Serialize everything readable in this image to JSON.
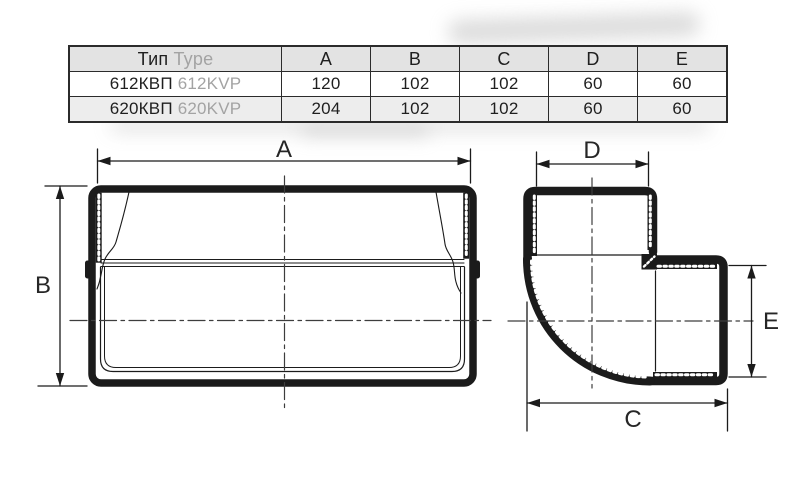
{
  "table": {
    "type_header": {
      "ru": "Тип",
      "en": "Type"
    },
    "dim_headers": [
      "A",
      "B",
      "C",
      "D",
      "E"
    ],
    "rows": [
      {
        "type_ru": "612КВП",
        "type_en": "612KVP",
        "values": [
          "120",
          "102",
          "102",
          "60",
          "60"
        ]
      },
      {
        "type_ru": "620КВП",
        "type_en": "620KVP",
        "values": [
          "204",
          "102",
          "102",
          "60",
          "60"
        ]
      }
    ]
  },
  "drawings": {
    "front_view": {
      "width_label": "A",
      "height_label": "B"
    },
    "elbow_view": {
      "top_label": "D",
      "right_label": "E",
      "bottom_label": "C"
    }
  },
  "colors": {
    "line": "#1b1b1b",
    "centerline": "#3d3d3d",
    "table_border": "#2b2b2b",
    "table_header_bg": "#e3e3e3",
    "table_alt_row_bg": "#ededed",
    "secondary_text": "#a3a3a3"
  }
}
